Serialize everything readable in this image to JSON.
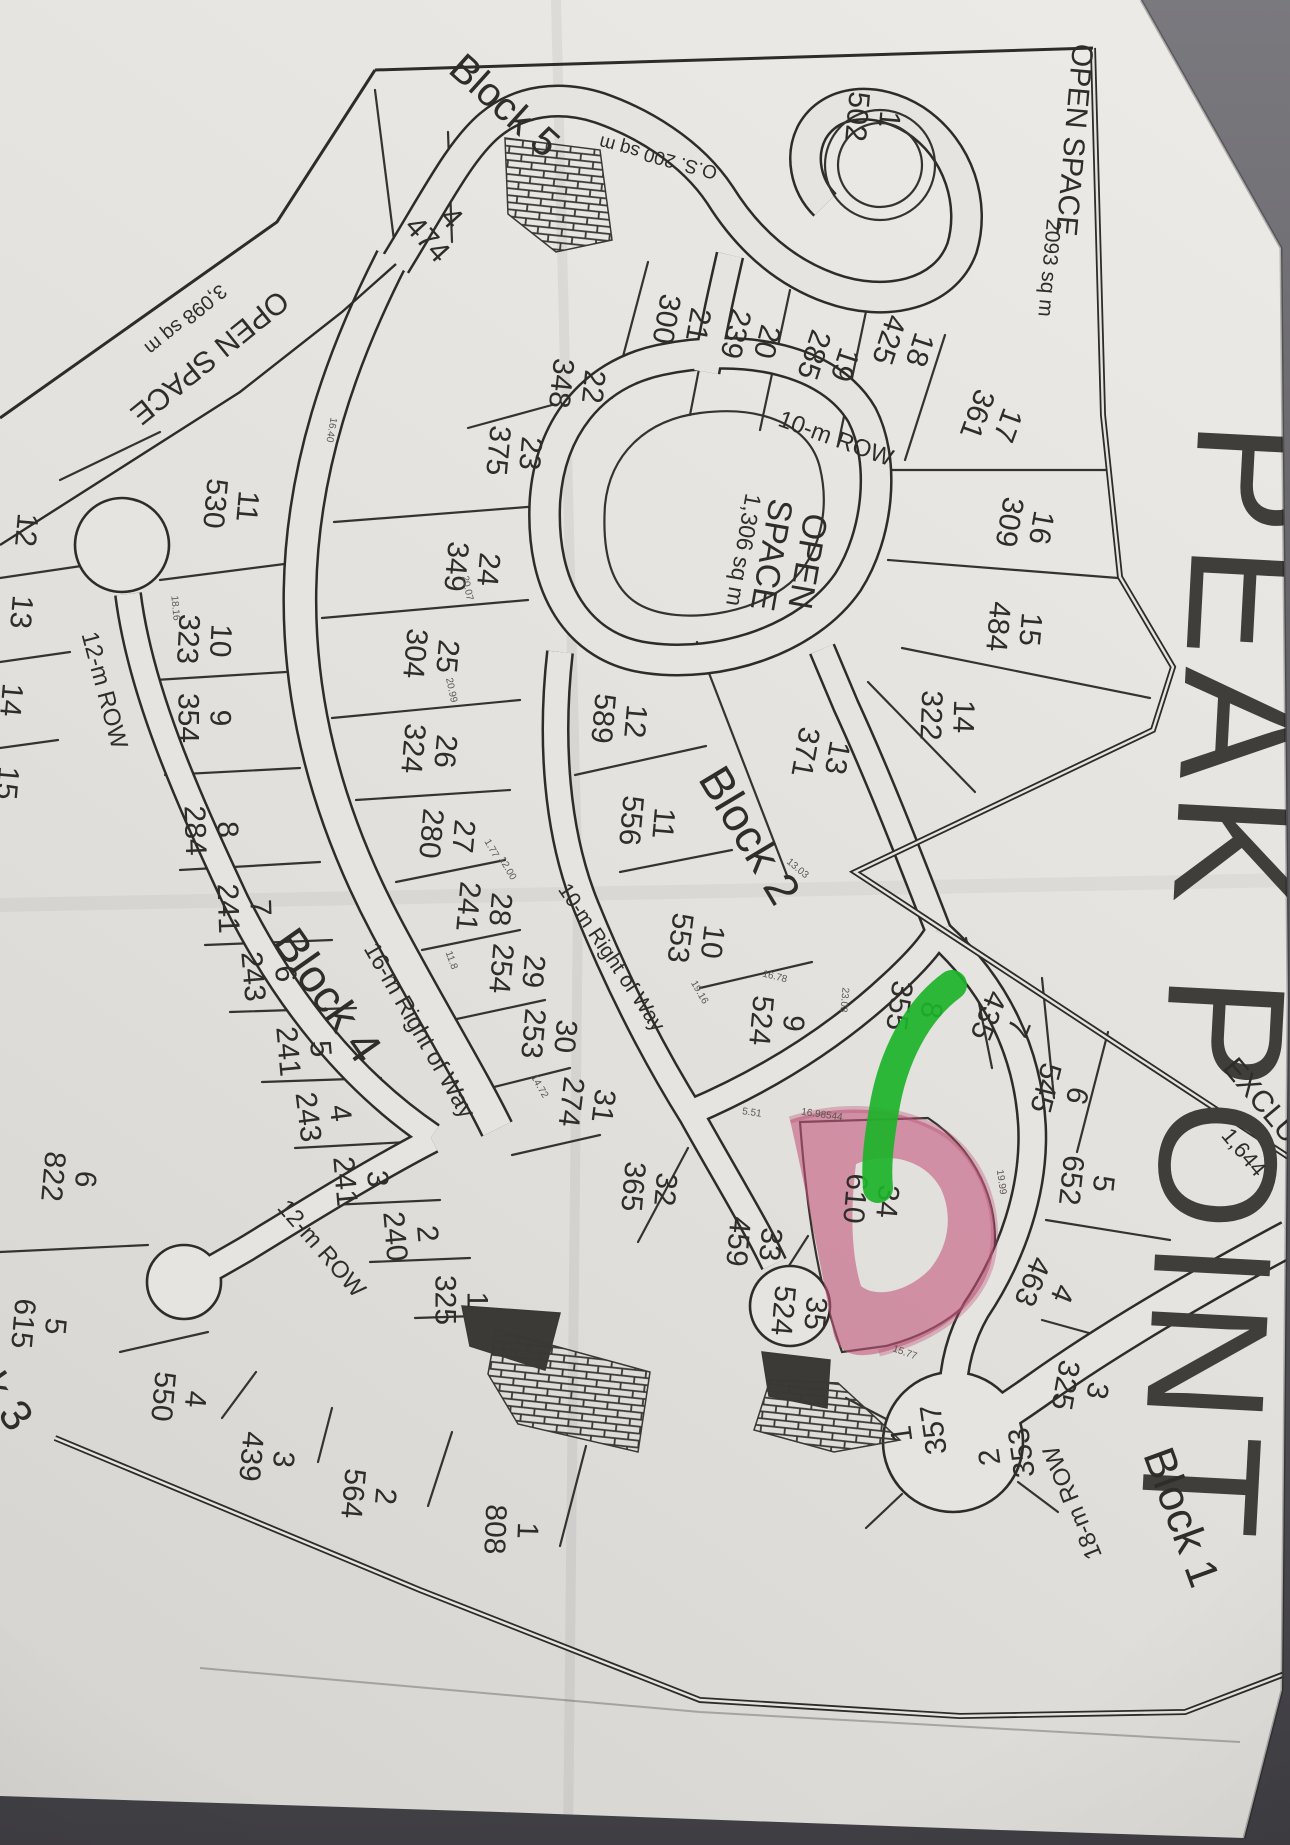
{
  "document": {
    "kind": "photographed subdivision plat map",
    "title": "PEAK POINT"
  },
  "map": {
    "blocks": [
      "Block 1",
      "Block 2",
      "Block 3",
      "Block 4",
      "Block 5"
    ],
    "open_spaces": [
      {
        "name": "OPEN SPACE",
        "area": "2093 sq m"
      },
      {
        "name": "OPEN SPACE",
        "area": "3,098 sq m"
      },
      {
        "name": "OPEN SPACE",
        "area": "1,306 sq m"
      },
      {
        "name": "O.S. 200 sq m",
        "area": "200 sq m"
      }
    ],
    "roads": [
      "10-m ROW",
      "10-m Right of Way",
      "12-m ROW",
      "12-m ROW",
      "16-m Right of Way",
      "18-m ROW"
    ],
    "exclusion": {
      "label": "EXCLU",
      "area": "1,644"
    },
    "annotations": {
      "highlight": {
        "lot_num": "34",
        "lot_area": "610",
        "color": "#c2557a"
      },
      "green_marker": {
        "color": "#1db32a"
      }
    },
    "labels": [
      {
        "id": "title",
        "lines": [
          "PEAK POINT"
        ],
        "x": 1228,
        "y": 985,
        "rot": 93,
        "size": 168,
        "cls": "title-text"
      },
      {
        "id": "open-space-ne",
        "lines": [
          "OPEN SPACE"
        ],
        "x": 1075,
        "y": 140,
        "rot": 95,
        "size": 30
      },
      {
        "id": "open-space-ne-area",
        "lines": [
          "2093 sq m"
        ],
        "x": 1050,
        "y": 268,
        "rot": 95,
        "size": 21
      },
      {
        "id": "open-space-nw",
        "lines": [
          "OPEN SPACE"
        ],
        "x": 210,
        "y": 358,
        "rot": 141,
        "size": 30
      },
      {
        "id": "open-space-nw-area",
        "lines": [
          "3,098 sq m"
        ],
        "x": 186,
        "y": 320,
        "rot": 141,
        "size": 20
      },
      {
        "id": "open-space-center",
        "lines": [
          "OPEN",
          "SPACE",
          "1,306 sq m"
        ],
        "x": 778,
        "y": 556,
        "rot": 100,
        "size": 34,
        "sizes": [
          34,
          34,
          23
        ]
      },
      {
        "id": "os-200",
        "lines": [
          "O.S. 200 sq m"
        ],
        "x": 658,
        "y": 158,
        "rot": 195,
        "size": 19
      },
      {
        "id": "row-10m",
        "lines": [
          "10-m ROW"
        ],
        "x": 836,
        "y": 438,
        "rot": 20,
        "size": 24
      },
      {
        "id": "row-10m-right-of-way",
        "lines": [
          "10-m Right of Way"
        ],
        "x": 612,
        "y": 957,
        "rot": 56,
        "size": 21
      },
      {
        "id": "row-16m-right-of-way",
        "lines": [
          "16-m Right of Way"
        ],
        "x": 420,
        "y": 1030,
        "rot": 60,
        "size": 24
      },
      {
        "id": "row-12m-west",
        "lines": [
          "12-m ROW"
        ],
        "x": 105,
        "y": 690,
        "rot": 75,
        "size": 24
      },
      {
        "id": "row-12m-south",
        "lines": [
          "12-m ROW"
        ],
        "x": 322,
        "y": 1248,
        "rot": 49,
        "size": 24
      },
      {
        "id": "row-18m",
        "lines": [
          "18-m ROW"
        ],
        "x": 1072,
        "y": 1503,
        "rot": 248,
        "size": 24
      },
      {
        "id": "block-5",
        "lines": [
          "Block 5"
        ],
        "x": 505,
        "y": 105,
        "rot": 42,
        "size": 40
      },
      {
        "id": "block-2",
        "lines": [
          "Block 2"
        ],
        "x": 750,
        "y": 835,
        "rot": 59,
        "size": 46
      },
      {
        "id": "block-4",
        "lines": [
          "Block 4"
        ],
        "x": 328,
        "y": 995,
        "rot": 55,
        "size": 46
      },
      {
        "id": "block-3",
        "lines": [
          "Block 3"
        ],
        "x": -18,
        "y": 1366,
        "rot": 55,
        "size": 44
      },
      {
        "id": "block-1",
        "lines": [
          "Block 1"
        ],
        "x": 1182,
        "y": 1517,
        "rot": 70,
        "size": 44
      },
      {
        "id": "exclusion",
        "lines": [
          "EXCLU"
        ],
        "x": 1262,
        "y": 1100,
        "rot": 50,
        "size": 30
      },
      {
        "id": "exclusion-area",
        "lines": [
          "1,644"
        ],
        "x": 1244,
        "y": 1152,
        "rot": 50,
        "size": 22
      },
      {
        "id": "lot-12-west",
        "lines": [
          "12"
        ],
        "x": 27,
        "y": 530,
        "rot": 95,
        "size": 30
      },
      {
        "id": "lot-13-west",
        "lines": [
          "13"
        ],
        "x": 22,
        "y": 612,
        "rot": 95,
        "size": 30
      },
      {
        "id": "lot-14-west",
        "lines": [
          "14"
        ],
        "x": 12,
        "y": 700,
        "rot": 95,
        "size": 30
      },
      {
        "id": "lot-15-west",
        "lines": [
          "15"
        ],
        "x": 8,
        "y": 783,
        "rot": 95,
        "size": 30
      }
    ],
    "lots": [
      {
        "num": "1",
        "area": "502",
        "x": 874,
        "y": 118,
        "rot": 95
      },
      {
        "num": "4",
        "area": "474",
        "x": 440,
        "y": 228,
        "rot": 48
      },
      {
        "num": "22",
        "area": "348",
        "x": 578,
        "y": 385,
        "rot": 96
      },
      {
        "num": "21",
        "area": "300",
        "x": 683,
        "y": 322,
        "rot": 100
      },
      {
        "num": "20",
        "area": "239",
        "x": 752,
        "y": 338,
        "rot": 104
      },
      {
        "num": "19",
        "area": "285",
        "x": 830,
        "y": 360,
        "rot": 108
      },
      {
        "num": "18",
        "area": "425",
        "x": 905,
        "y": 345,
        "rot": 108
      },
      {
        "num": "17",
        "area": "361",
        "x": 993,
        "y": 420,
        "rot": 110
      },
      {
        "num": "16",
        "area": "309",
        "x": 1026,
        "y": 525,
        "rot": 100
      },
      {
        "num": "15",
        "area": "484",
        "x": 1015,
        "y": 628,
        "rot": 95
      },
      {
        "num": "14",
        "area": "322",
        "x": 948,
        "y": 716,
        "rot": 92
      },
      {
        "num": "13",
        "area": "371",
        "x": 822,
        "y": 755,
        "rot": 100
      },
      {
        "num": "12",
        "area": "589",
        "x": 620,
        "y": 720,
        "rot": 95
      },
      {
        "num": "11",
        "area": "556",
        "x": 648,
        "y": 822,
        "rot": 95
      },
      {
        "num": "10",
        "area": "553",
        "x": 697,
        "y": 940,
        "rot": 97
      },
      {
        "num": "9",
        "area": "524",
        "x": 778,
        "y": 1022,
        "rot": 95
      },
      {
        "num": "8",
        "area": "355",
        "x": 916,
        "y": 1008,
        "rot": 98
      },
      {
        "num": "7",
        "area": "435",
        "x": 1004,
        "y": 1022,
        "rot": 112
      },
      {
        "num": "6",
        "area": "545",
        "x": 1062,
        "y": 1092,
        "rot": 104
      },
      {
        "num": "5",
        "area": "652",
        "x": 1088,
        "y": 1182,
        "rot": 96
      },
      {
        "num": "4",
        "area": "463",
        "x": 1048,
        "y": 1288,
        "rot": 112
      },
      {
        "num": "3",
        "area": "325",
        "x": 1082,
        "y": 1388,
        "rot": 100
      },
      {
        "num": "2",
        "area": "353",
        "x": 1005,
        "y": 1455,
        "rot": 262
      },
      {
        "num": "1",
        "area": "357",
        "x": 917,
        "y": 1432,
        "rot": 262
      },
      {
        "num": "23",
        "area": "375",
        "x": 515,
        "y": 452,
        "rot": 95
      },
      {
        "num": "24",
        "area": "349",
        "x": 473,
        "y": 568,
        "rot": 95
      },
      {
        "num": "25",
        "area": "304",
        "x": 432,
        "y": 655,
        "rot": 95
      },
      {
        "num": "26",
        "area": "324",
        "x": 430,
        "y": 750,
        "rot": 95
      },
      {
        "num": "27",
        "area": "280",
        "x": 448,
        "y": 835,
        "rot": 95
      },
      {
        "num": "28",
        "area": "241",
        "x": 485,
        "y": 908,
        "rot": 95
      },
      {
        "num": "29",
        "area": "254",
        "x": 518,
        "y": 970,
        "rot": 95
      },
      {
        "num": "30",
        "area": "253",
        "x": 550,
        "y": 1035,
        "rot": 95
      },
      {
        "num": "31",
        "area": "274",
        "x": 588,
        "y": 1104,
        "rot": 97
      },
      {
        "num": "32",
        "area": "365",
        "x": 650,
        "y": 1188,
        "rot": 95
      },
      {
        "num": "33",
        "area": "459",
        "x": 755,
        "y": 1243,
        "rot": 95
      },
      {
        "num": "34",
        "area": "610",
        "x": 872,
        "y": 1200,
        "rot": 95,
        "highlighted": true
      },
      {
        "num": "35",
        "area": "524",
        "x": 800,
        "y": 1312,
        "rot": 95
      },
      {
        "num": "11",
        "area": "530",
        "x": 232,
        "y": 505,
        "rot": 95
      },
      {
        "num": "10",
        "area": "323",
        "x": 205,
        "y": 640,
        "rot": 93
      },
      {
        "num": "9",
        "area": "354",
        "x": 205,
        "y": 718,
        "rot": 90
      },
      {
        "num": "8",
        "area": "284",
        "x": 212,
        "y": 830,
        "rot": 88
      },
      {
        "num": "7",
        "area": "241",
        "x": 245,
        "y": 908,
        "rot": 88
      },
      {
        "num": "6",
        "area": "243",
        "x": 270,
        "y": 975,
        "rot": 85
      },
      {
        "num": "5",
        "area": "241",
        "x": 305,
        "y": 1050,
        "rot": 85
      },
      {
        "num": "4",
        "area": "243",
        "x": 325,
        "y": 1115,
        "rot": 83
      },
      {
        "num": "3",
        "area": "241",
        "x": 362,
        "y": 1180,
        "rot": 85
      },
      {
        "num": "2",
        "area": "240",
        "x": 412,
        "y": 1235,
        "rot": 85
      },
      {
        "num": "1",
        "area": "325",
        "x": 462,
        "y": 1300,
        "rot": 90
      },
      {
        "num": "6",
        "area": "822",
        "x": 70,
        "y": 1178,
        "rot": 95
      },
      {
        "num": "5",
        "area": "615",
        "x": 40,
        "y": 1325,
        "rot": 95
      },
      {
        "num": "4",
        "area": "550",
        "x": 180,
        "y": 1398,
        "rot": 95
      },
      {
        "num": "3",
        "area": "439",
        "x": 268,
        "y": 1458,
        "rot": 95
      },
      {
        "num": "2",
        "area": "564",
        "x": 370,
        "y": 1495,
        "rot": 95
      },
      {
        "num": "1",
        "area": "808",
        "x": 512,
        "y": 1530,
        "rot": 92
      }
    ],
    "dims": [
      {
        "t": "20.99",
        "x": 452,
        "y": 690,
        "r": 78
      },
      {
        "t": "20.07",
        "x": 468,
        "y": 588,
        "r": 78
      },
      {
        "t": "5.51",
        "x": 752,
        "y": 1112,
        "r": 8
      },
      {
        "t": "16.98544",
        "x": 822,
        "y": 1114,
        "r": 8
      },
      {
        "t": "16.78",
        "x": 775,
        "y": 976,
        "r": 14
      },
      {
        "t": "23.03",
        "x": 845,
        "y": 1000,
        "r": 95
      },
      {
        "t": "13.03",
        "x": 798,
        "y": 868,
        "r": 40
      },
      {
        "t": "19.16",
        "x": 700,
        "y": 992,
        "r": 60
      },
      {
        "t": "14.72",
        "x": 540,
        "y": 1086,
        "r": 60
      },
      {
        "t": "11.8",
        "x": 452,
        "y": 960,
        "r": 70
      },
      {
        "t": "15.77",
        "x": 905,
        "y": 1352,
        "r": 20
      },
      {
        "t": "19.99",
        "x": 1002,
        "y": 1182,
        "r": 82
      },
      {
        "t": "16.40",
        "x": 332,
        "y": 430,
        "r": 100
      },
      {
        "t": "18.16",
        "x": 176,
        "y": 608,
        "r": 85
      },
      {
        "t": "12.00",
        "x": 508,
        "y": 868,
        "r": 60
      },
      {
        "t": "1.77",
        "x": 492,
        "y": 848,
        "r": 60
      }
    ]
  }
}
